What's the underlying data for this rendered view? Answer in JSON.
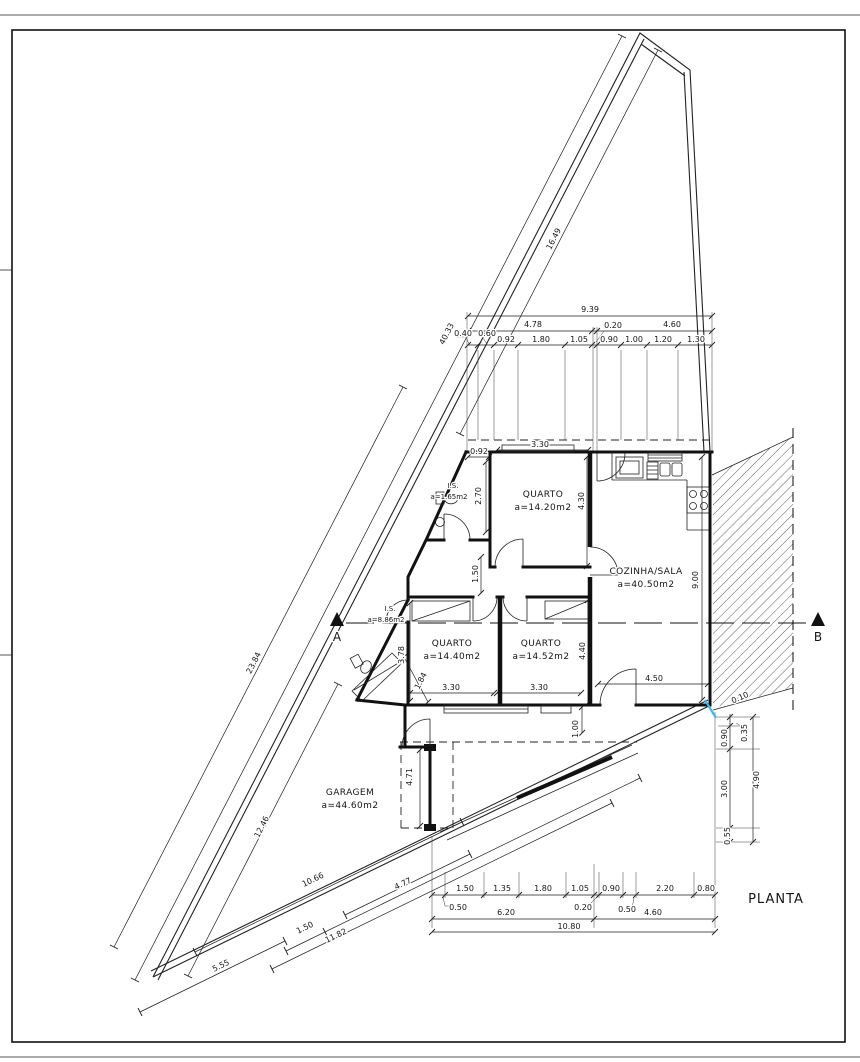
{
  "sheet": {
    "title": "PLANTA"
  },
  "section_markers": {
    "a": "A",
    "b": "B"
  },
  "colors": {
    "line": "#1f1f1f",
    "accent_blue": "#3fb6e8"
  },
  "rooms": [
    {
      "name": "QUARTO",
      "area": "a=14.20m2",
      "x": 543,
      "y": 497,
      "small": false
    },
    {
      "name": "QUARTO",
      "area": "a=14.40m2",
      "x": 452,
      "y": 646,
      "small": false
    },
    {
      "name": "QUARTO",
      "area": "a=14.52m2",
      "x": 541,
      "y": 646,
      "small": false
    },
    {
      "name": "COZINHA/SALA",
      "area": "a=40.50m2",
      "x": 646,
      "y": 574,
      "small": false
    },
    {
      "name": "GARAGEM",
      "area": "a=44.60m2",
      "x": 350,
      "y": 795,
      "small": false
    },
    {
      "name": "I.S.",
      "area": "a=1.65m2",
      "x": 453,
      "y": 488,
      "small": true
    },
    {
      "name": "I.S.",
      "area": "a=8.86m2",
      "x": 390,
      "y": 611,
      "small": true
    }
  ],
  "dim_labels": [
    {
      "t": "9.39",
      "x": 590,
      "y": 312
    },
    {
      "t": "4.78",
      "x": 533,
      "y": 327
    },
    {
      "t": "0.20",
      "x": 613,
      "y": 328
    },
    {
      "t": "4.60",
      "x": 672,
      "y": 327
    },
    {
      "t": "0.40",
      "x": 463,
      "y": 336
    },
    {
      "t": "0.60",
      "x": 487,
      "y": 336
    },
    {
      "t": "0.92",
      "x": 506,
      "y": 342
    },
    {
      "t": "1.80",
      "x": 541,
      "y": 342
    },
    {
      "t": "1.05",
      "x": 579,
      "y": 342
    },
    {
      "t": "0.90",
      "x": 609,
      "y": 342
    },
    {
      "t": "1.00",
      "x": 634,
      "y": 342
    },
    {
      "t": "1.20",
      "x": 663,
      "y": 342
    },
    {
      "t": "1.30",
      "x": 696,
      "y": 342
    },
    {
      "t": "1.50",
      "x": 465,
      "y": 891
    },
    {
      "t": "1.35",
      "x": 502,
      "y": 891
    },
    {
      "t": "1.80",
      "x": 543,
      "y": 891
    },
    {
      "t": "1.05",
      "x": 580,
      "y": 891
    },
    {
      "t": "0.90",
      "x": 611,
      "y": 891
    },
    {
      "t": "2.20",
      "x": 665,
      "y": 891
    },
    {
      "t": "0.80",
      "x": 706,
      "y": 891
    },
    {
      "t": "0.50",
      "x": 458,
      "y": 910
    },
    {
      "t": "0.20",
      "x": 583,
      "y": 910
    },
    {
      "t": "0.50",
      "x": 627,
      "y": 912
    },
    {
      "t": "6.20",
      "x": 506,
      "y": 915
    },
    {
      "t": "4.60",
      "x": 653,
      "y": 915
    },
    {
      "t": "10.80",
      "x": 569,
      "y": 929
    },
    {
      "t": "16.49",
      "x": 556,
      "y": 240,
      "r": -63
    },
    {
      "t": "40.33",
      "x": 449,
      "y": 335,
      "r": -63
    },
    {
      "t": "23.84",
      "x": 256,
      "y": 664,
      "r": -63
    },
    {
      "t": "12.46",
      "x": 264,
      "y": 828,
      "r": -63
    },
    {
      "t": "10.66",
      "x": 314,
      "y": 882,
      "r": -26
    },
    {
      "t": "4.77",
      "x": 404,
      "y": 886,
      "r": -26
    },
    {
      "t": "1.50",
      "x": 306,
      "y": 930,
      "r": -26
    },
    {
      "t": "11.82",
      "x": 337,
      "y": 938,
      "r": -26
    },
    {
      "t": "5.55",
      "x": 222,
      "y": 968,
      "r": -26
    },
    {
      "t": "3.30",
      "x": 540,
      "y": 447
    },
    {
      "t": "0.92",
      "x": 479,
      "y": 454
    },
    {
      "t": "4.30",
      "x": 584,
      "y": 501,
      "r": -90
    },
    {
      "t": "2.70",
      "x": 481,
      "y": 496,
      "r": -90
    },
    {
      "t": "1.50",
      "x": 478,
      "y": 574,
      "r": -90
    },
    {
      "t": "3.78",
      "x": 404,
      "y": 655,
      "r": -90
    },
    {
      "t": "1.84",
      "x": 423,
      "y": 682,
      "r": -63
    },
    {
      "t": "3.30",
      "x": 451,
      "y": 690
    },
    {
      "t": "3.30",
      "x": 539,
      "y": 690
    },
    {
      "t": "4.40",
      "x": 585,
      "y": 651,
      "r": -90
    },
    {
      "t": "4.50",
      "x": 654,
      "y": 681
    },
    {
      "t": "9.00",
      "x": 698,
      "y": 580,
      "r": -90
    },
    {
      "t": "1.00",
      "x": 578,
      "y": 729,
      "r": -90
    },
    {
      "t": "4.71",
      "x": 412,
      "y": 777,
      "r": -90
    },
    {
      "t": "0.90",
      "x": 727,
      "y": 738,
      "r": -90
    },
    {
      "t": "0.35",
      "x": 747,
      "y": 733,
      "r": -90
    },
    {
      "t": "3.00",
      "x": 727,
      "y": 789,
      "r": -90
    },
    {
      "t": "0.55",
      "x": 730,
      "y": 836,
      "r": -90
    },
    {
      "t": "4.90",
      "x": 759,
      "y": 780,
      "r": -90
    },
    {
      "t": "0.10",
      "x": 741,
      "y": 700,
      "r": -24
    }
  ]
}
